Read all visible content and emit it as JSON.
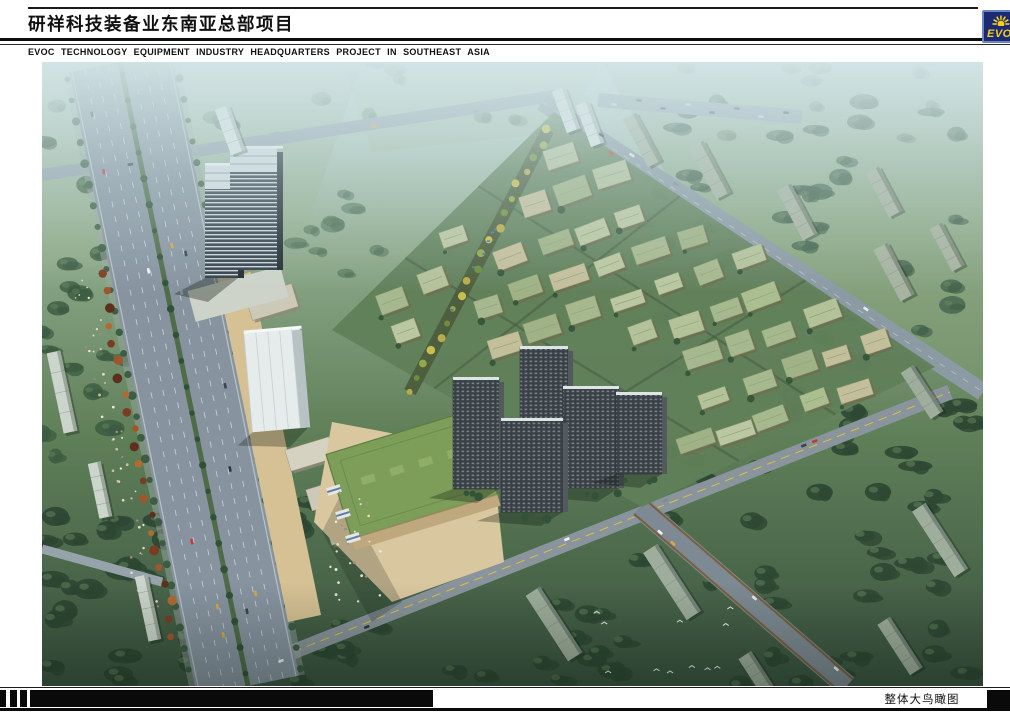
{
  "header": {
    "title_cn": "研祥科技装备业东南亚总部项目",
    "subtitle_en": "EVOC TECHNOLOGY EQUIPMENT INDUSTRY HEADQUARTERS PROJECT IN SOUTHEAST ASIA",
    "logo": {
      "text": "EVOC",
      "bg_color": "#1c2a74",
      "border_color": "#6a84c4",
      "accent_color": "#f2cf1d"
    }
  },
  "footer": {
    "caption": "整体大鸟瞰图"
  },
  "palette": {
    "haze_sky": "#c3d8da",
    "grass_light": "#8fab8d",
    "grass_mid": "#5f7f58",
    "forest_dark": "#2c4632",
    "road_asphalt": "#8794a0",
    "site_green": "#60805a",
    "roof_sage": "#a8bb8e",
    "plaza_paving": "#d9c7a0",
    "podium_roof_green": "#7c9e58",
    "highrise_dark": "#3a4146",
    "tower_glass": "#33404a",
    "autumn_tree": "#8a4526"
  }
}
